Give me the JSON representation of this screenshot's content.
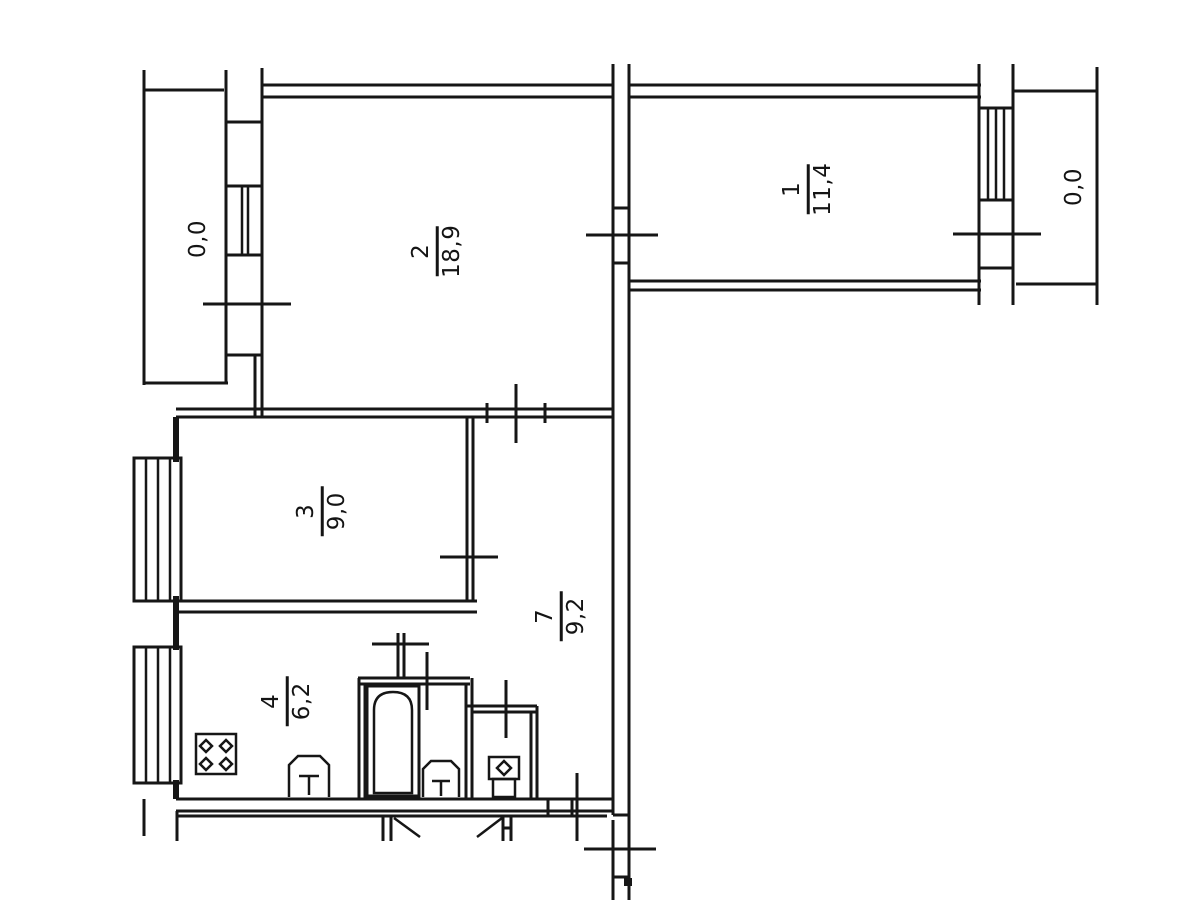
{
  "plan": {
    "title": "apartment-floor-plan",
    "background": "#ffffff",
    "ink": "#161616",
    "rooms": [
      {
        "number": "1",
        "area": "11,4"
      },
      {
        "number": "2",
        "area": "18,9"
      },
      {
        "number": "3",
        "area": "9,0"
      },
      {
        "number": "4",
        "area": "6,2"
      },
      {
        "number": "7",
        "area": "9,2"
      }
    ],
    "balconies": [
      {
        "area": "0,0"
      },
      {
        "area": "0,0"
      }
    ],
    "fixtures": [
      "stove-icon",
      "bathtub-icon",
      "bathroom-sink-icon",
      "kitchen-sink-icon",
      "toilet-icon"
    ]
  }
}
